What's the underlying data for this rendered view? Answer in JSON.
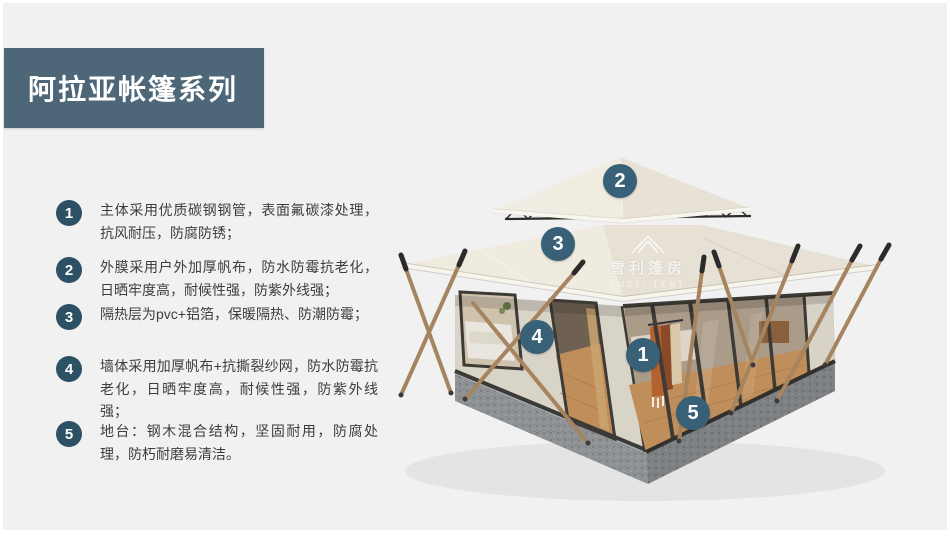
{
  "header": {
    "title": "阿拉亚帐篷系列"
  },
  "features": [
    {
      "num": "1",
      "text": "主体采用优质碳钢钢管，表面氟碳漆处理，抗风耐压，防腐防锈；"
    },
    {
      "num": "2",
      "text": "外膜采用户外加厚帆布，防水防霉抗老化，日晒牢度高，耐候性强，防紫外线强；"
    },
    {
      "num": "3",
      "text": "隔热层为pvc+铝箔，保暖隔热、防潮防霉；"
    },
    {
      "num": "4",
      "text": "墙体采用加厚帆布+抗撕裂纱网，防水防霉抗老化，日晒牢度高，耐候性强，防紫外线强；"
    },
    {
      "num": "5",
      "text": "地台：钢木混合结构，坚固耐用，防腐处理，防朽耐磨易清洁。"
    }
  ],
  "markers": [
    {
      "num": "2"
    },
    {
      "num": "3"
    },
    {
      "num": "4"
    },
    {
      "num": "1"
    },
    {
      "num": "5"
    }
  ],
  "watermark": {
    "cn": "雪利篷房",
    "en": "YUELI TENT"
  },
  "colors": {
    "background": "#f1f1f2",
    "banner": "#4d6778",
    "list_circle": "#2c5064",
    "marker_circle": "#386076",
    "body_text": "#3d3d3d",
    "tent_canvas": "#ebe7db",
    "base_concrete": "#8f9294"
  }
}
